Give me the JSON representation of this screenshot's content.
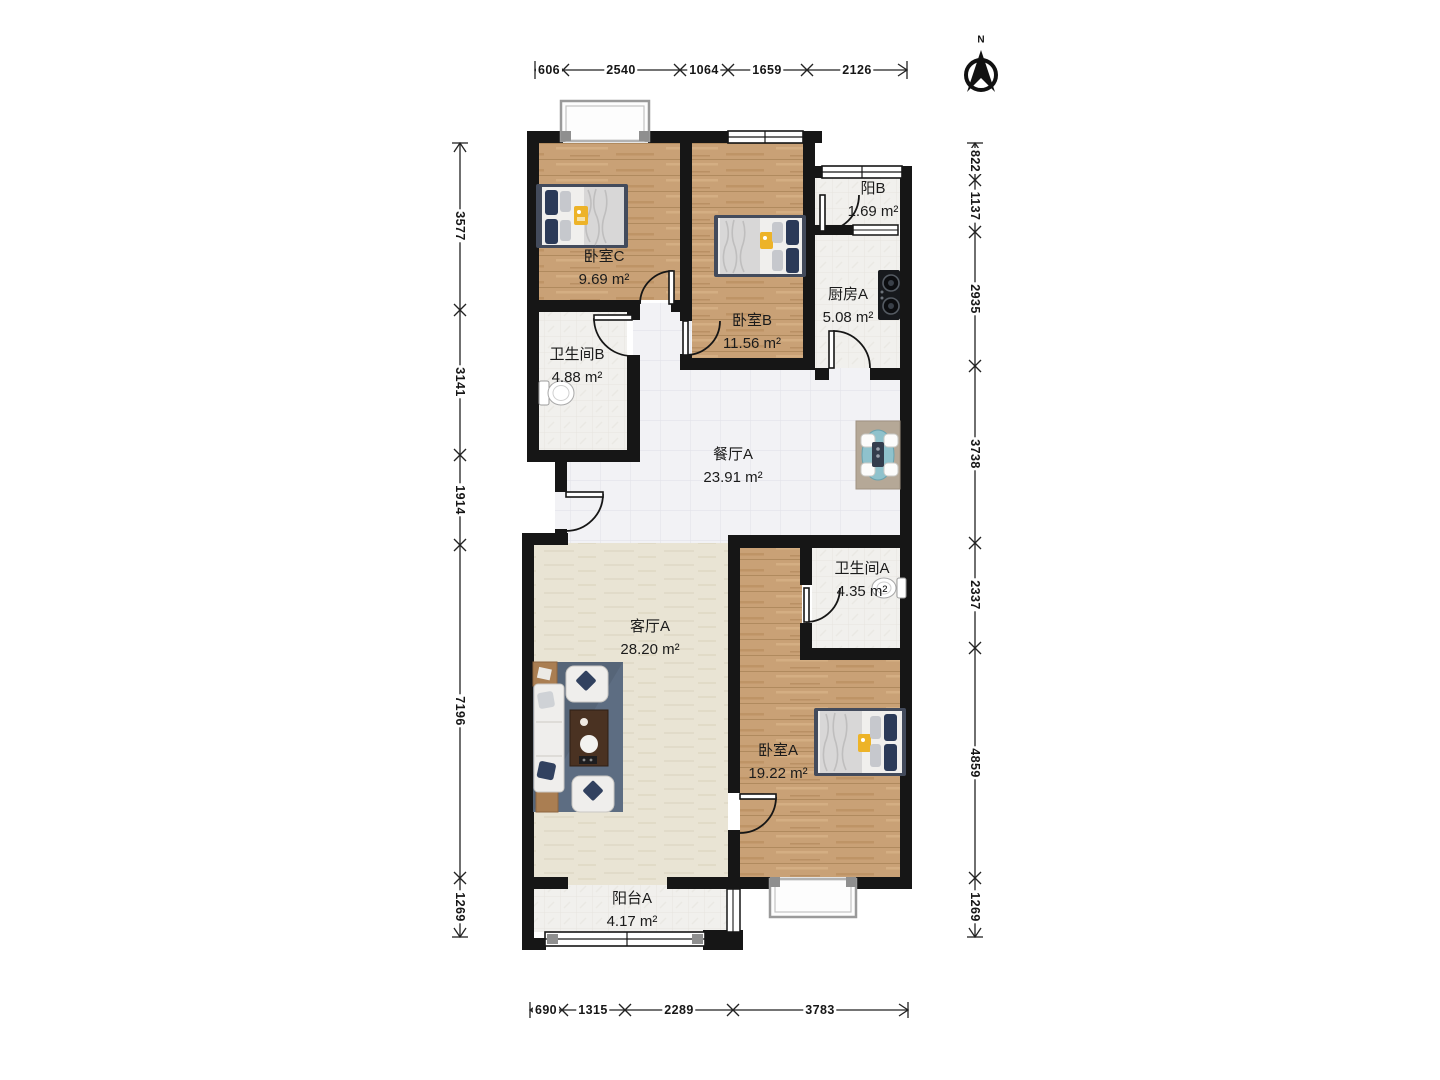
{
  "compass": {
    "north_label": "N"
  },
  "rooms": [
    {
      "id": "bedroom-c",
      "name": "卧室C",
      "area": "9.69 m²"
    },
    {
      "id": "bathroom-b",
      "name": "卫生间B",
      "area": "4.88 m²"
    },
    {
      "id": "bedroom-b",
      "name": "卧室B",
      "area": "11.56 m²"
    },
    {
      "id": "balcony-b",
      "name": "阳B",
      "area": "1.69 m²"
    },
    {
      "id": "kitchen-a",
      "name": "厨房A",
      "area": "5.08 m²"
    },
    {
      "id": "dining-a",
      "name": "餐厅A",
      "area": "23.91 m²"
    },
    {
      "id": "bathroom-a",
      "name": "卫生间A",
      "area": "4.35 m²"
    },
    {
      "id": "living-a",
      "name": "客厅A",
      "area": "28.20 m²"
    },
    {
      "id": "bedroom-a",
      "name": "卧室A",
      "area": "19.22 m²"
    },
    {
      "id": "balcony-a",
      "name": "阳台A",
      "area": "4.17 m²"
    }
  ],
  "dimensions": {
    "top": [
      "606",
      "2540",
      "1064",
      "1659",
      "2126"
    ],
    "left": [
      "3577",
      "3141",
      "1914",
      "7196",
      "1269"
    ],
    "right": [
      "822",
      "1137",
      "2935",
      "3738",
      "2337",
      "4859",
      "1269"
    ],
    "bottom": [
      "690",
      "1315",
      "2289",
      "3783"
    ]
  },
  "colors": {
    "wall": "#161616",
    "wood_floor": "#c9a176",
    "tile_floor": "#f1f1f4",
    "living_floor": "#e9e4d4",
    "rug": "#5d6d82",
    "pillow_navy": "#2b3a58",
    "accent_yellow": "#edb328",
    "table_teal": "#86bcc6"
  }
}
